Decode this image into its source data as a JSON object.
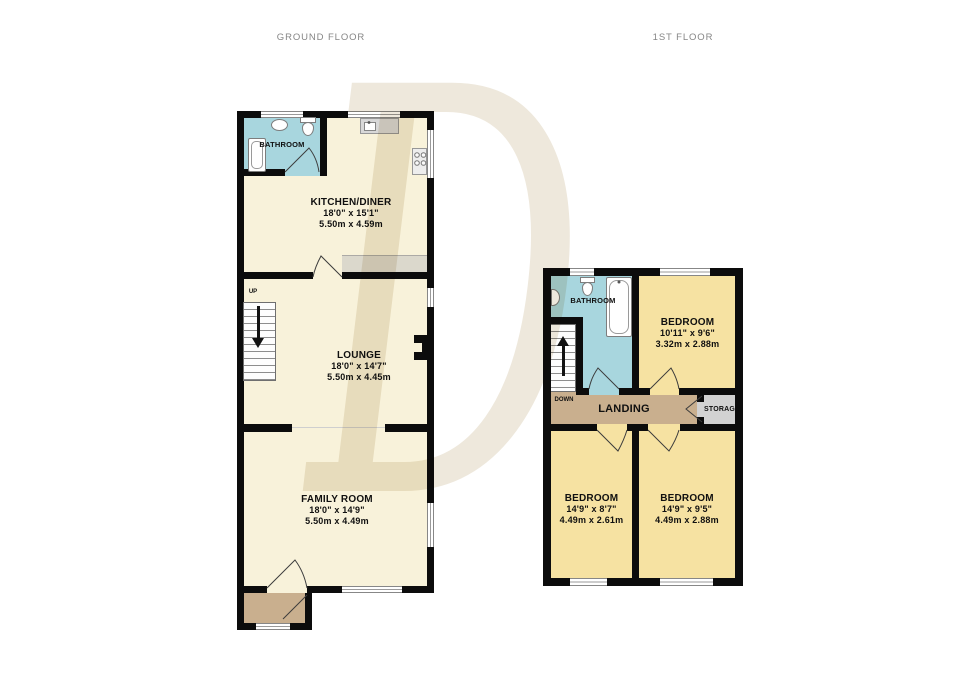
{
  "titles": {
    "ground_floor": "GROUND FLOOR",
    "first_floor": "1ST FLOOR"
  },
  "watermark": {
    "letter": "D"
  },
  "colors": {
    "wall": "#0c0c0c",
    "floor_cream": "#f8f2da",
    "bathroom_blue": "#a8d6de",
    "bedroom_yellow": "#f6e2a2",
    "landing_tan": "#c9af8e",
    "storage_grey": "#d2d2d2",
    "title_grey": "#868686",
    "label_black": "#101010",
    "watermark_beige": "#eee8dc"
  },
  "ground_floor": {
    "bathroom": {
      "name": "BATHROOM"
    },
    "kitchen_diner": {
      "name": "KITCHEN/DINER",
      "size_imperial": "18'0\" x 15'1\"",
      "size_metric": "5.50m x 4.59m"
    },
    "lounge": {
      "name": "LOUNGE",
      "size_imperial": "18'0\" x 14'7\"",
      "size_metric": "5.50m x 4.45m"
    },
    "family_room": {
      "name": "FAMILY ROOM",
      "size_imperial": "18'0\" x 14'9\"",
      "size_metric": "5.50m x 4.49m"
    },
    "stairs": {
      "label": "UP"
    }
  },
  "first_floor": {
    "bathroom": {
      "name": "BATHROOM"
    },
    "bedroom_top": {
      "name": "BEDROOM",
      "size_imperial": "10'11\" x 9'6\"",
      "size_metric": "3.32m x 2.88m"
    },
    "landing": {
      "name": "LANDING"
    },
    "storage": {
      "name": "STORAGE"
    },
    "bedroom_left": {
      "name": "BEDROOM",
      "size_imperial": "14'9\" x 8'7\"",
      "size_metric": "4.49m x 2.61m"
    },
    "bedroom_right": {
      "name": "BEDROOM",
      "size_imperial": "14'9\" x 9'5\"",
      "size_metric": "4.49m x 2.88m"
    },
    "stairs": {
      "label": "DOWN"
    }
  }
}
